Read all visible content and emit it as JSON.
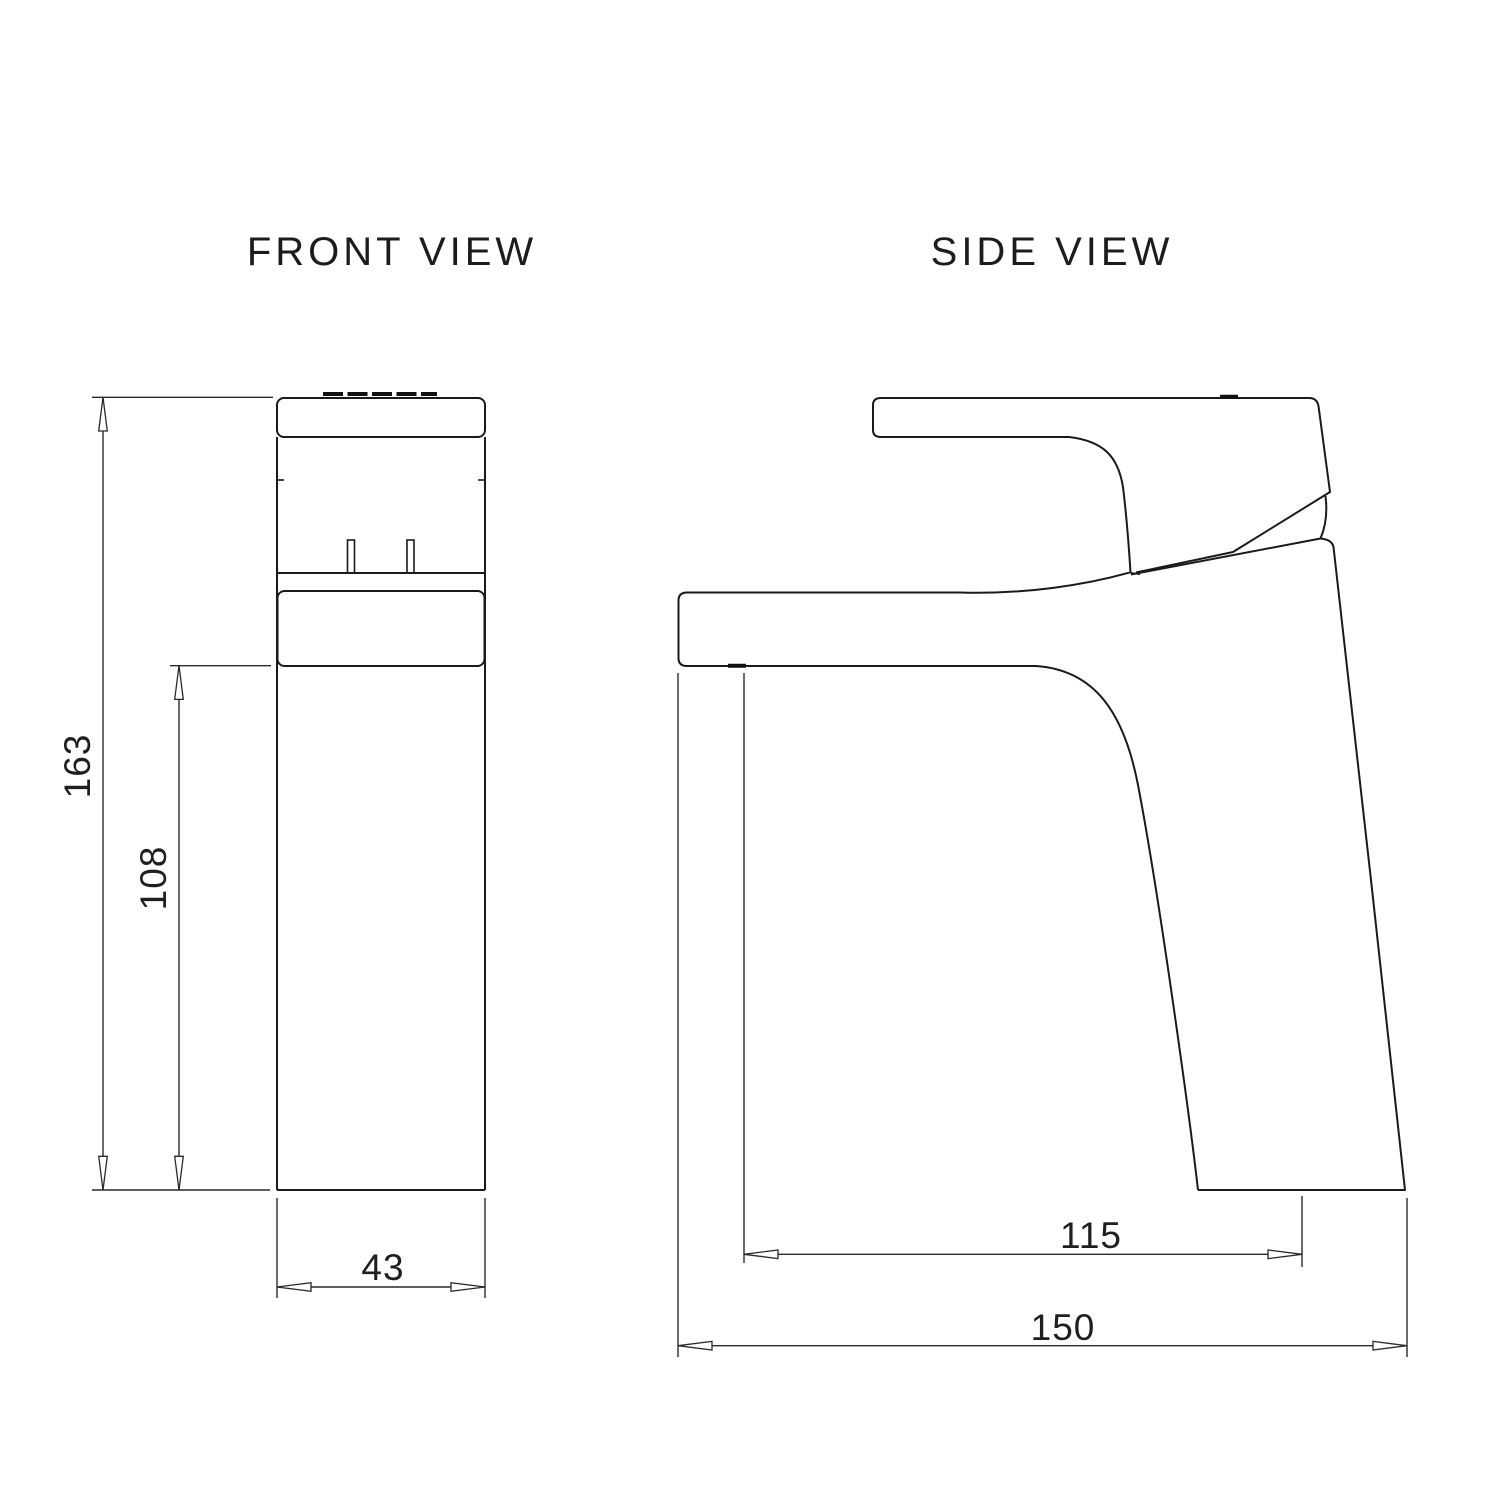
{
  "page": {
    "background_color": "#ffffff",
    "line_color": "#1a1a1a",
    "dimension_color": "#2a2a2a"
  },
  "views": {
    "front": {
      "title": "FRONT VIEW",
      "dims": {
        "total_height": "163",
        "spout_height": "108",
        "body_width": "43"
      }
    },
    "side": {
      "title": "SIDE VIEW",
      "dims": {
        "spout_reach": "115",
        "total_depth": "150"
      }
    }
  }
}
